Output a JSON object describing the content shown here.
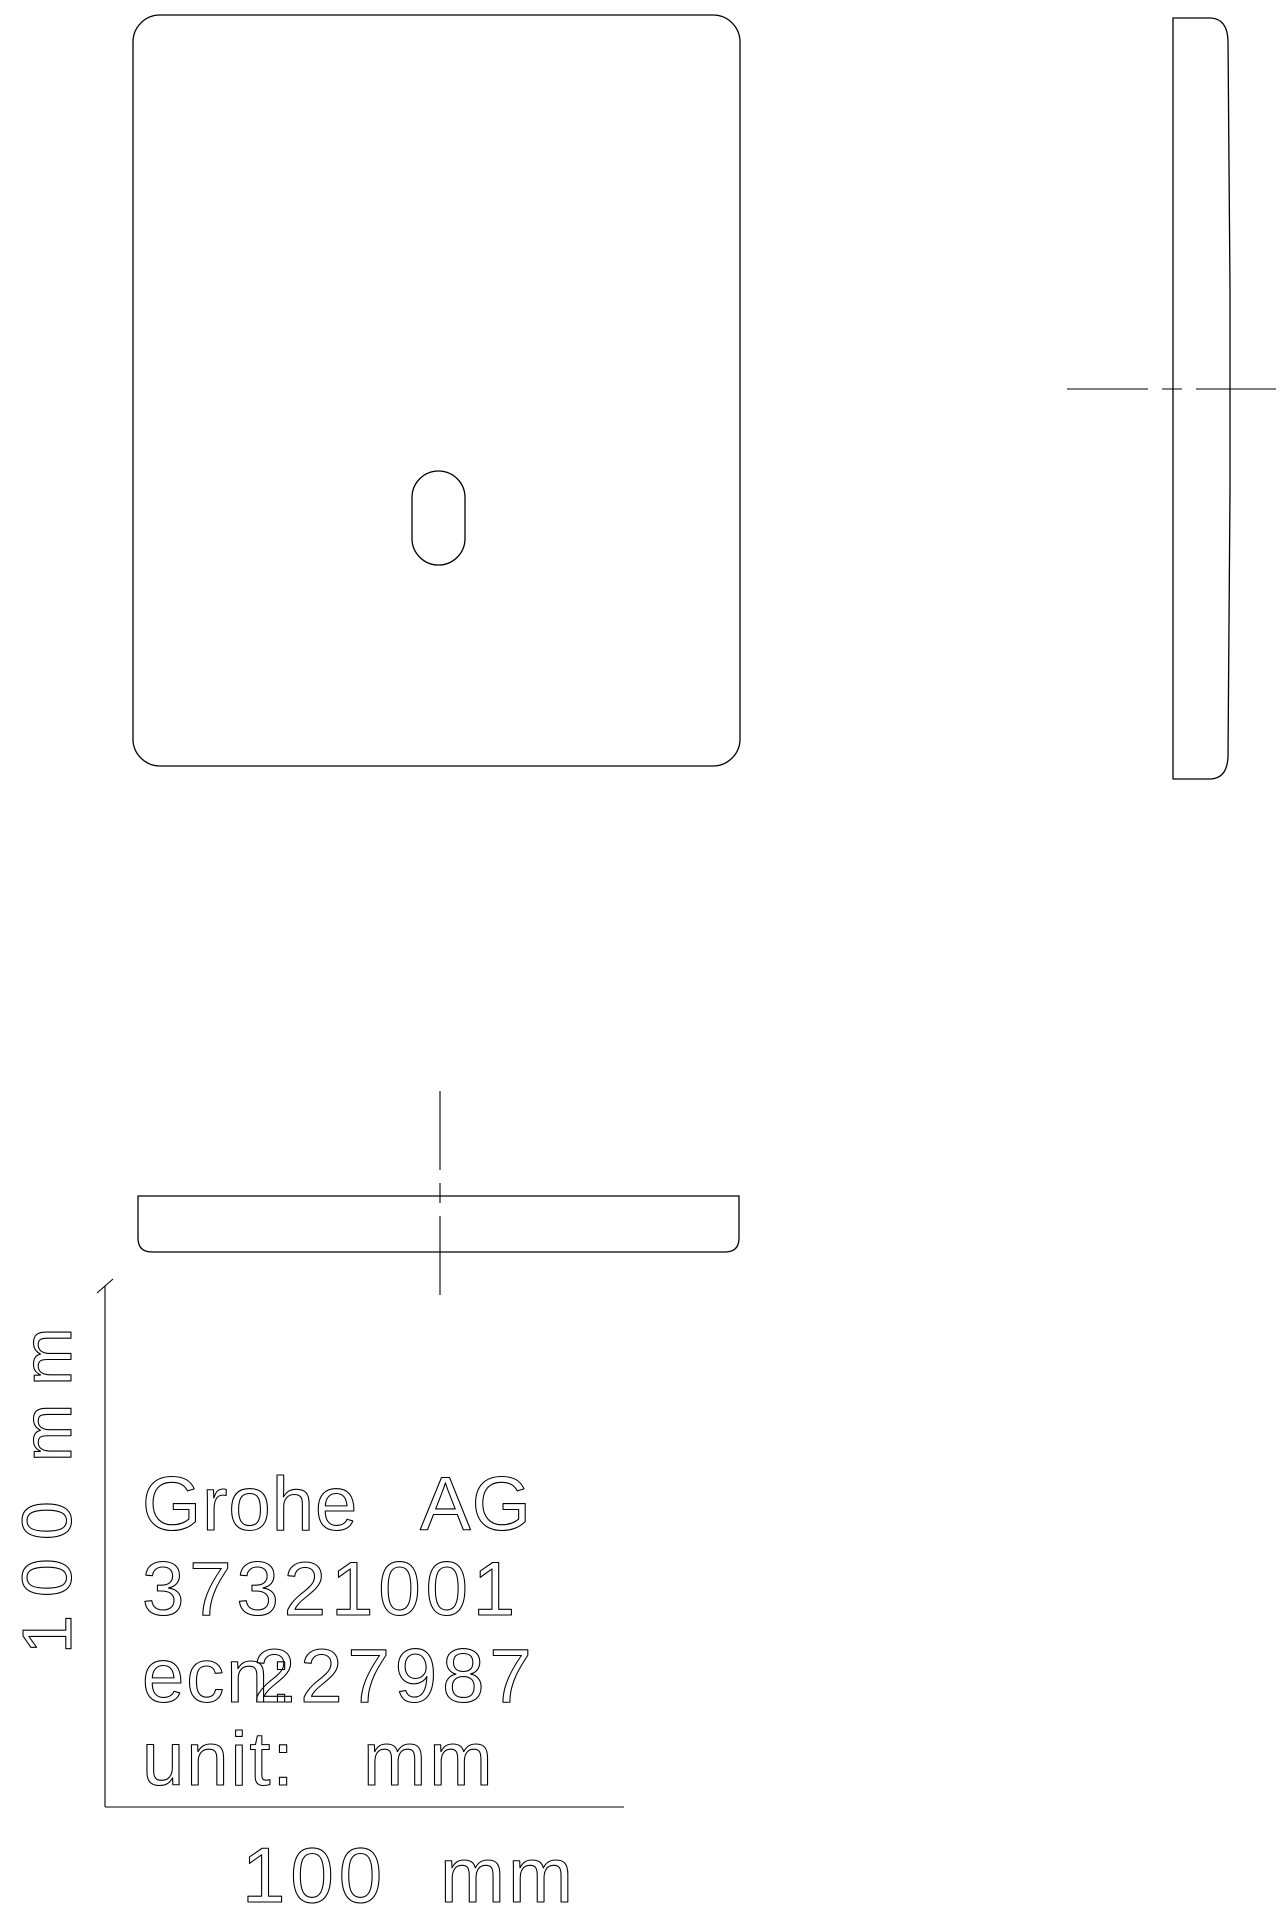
{
  "labels": {
    "company_word1": "Grohe",
    "company_word2": "AG",
    "part_number": "37321001",
    "ecn_prefix": "ecn:",
    "ecn_number": "227987",
    "unit_label": "unit:",
    "unit_value": "mm",
    "dim_bottom_value": "100",
    "dim_bottom_unit": "mm",
    "dim_left_value": "100",
    "dim_left_unit": "mm"
  },
  "colors": {
    "line": "#000000",
    "background": "#ffffff"
  }
}
